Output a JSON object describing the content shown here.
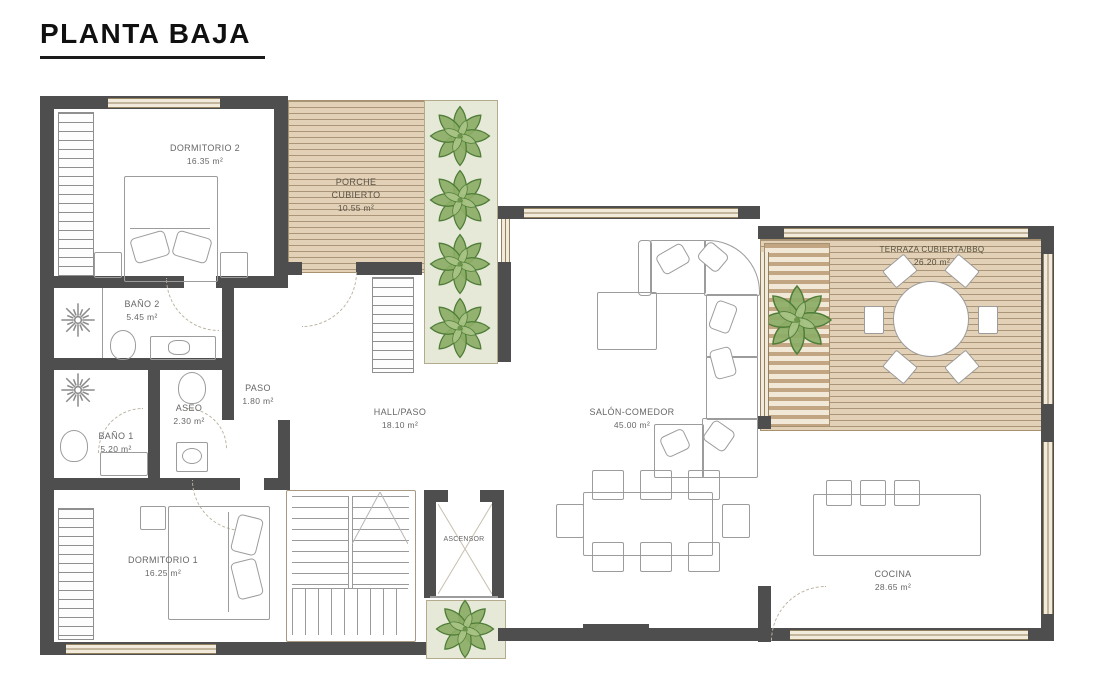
{
  "title": "PLANTA BAJA",
  "rooms": {
    "dormitorio2": {
      "name": "DORMITORIO 2",
      "area": "16.35 m²"
    },
    "porche": {
      "line1": "PORCHE",
      "line2": "CUBIERTO",
      "area": "10.55 m²"
    },
    "bano2": {
      "name": "BAÑO 2",
      "area": "5.45 m²"
    },
    "paso": {
      "name": "PASO",
      "area": "1.80 m²"
    },
    "aseo": {
      "name": "ASEO",
      "area": "2.30 m²"
    },
    "bano1": {
      "name": "BAÑO 1",
      "area": "5.20 m²"
    },
    "dormitorio1": {
      "name": "DORMITORIO 1",
      "area": "16.25 m²"
    },
    "hall": {
      "name": "HALL/PASO",
      "area": "18.10 m²"
    },
    "ascensor": {
      "name": "ASCENSOR"
    },
    "salon": {
      "name": "SALÓN-COMEDOR",
      "area": "45.00 m²"
    },
    "terraza": {
      "name": "TERRAZA CUBIERTA/BBQ",
      "area": "26.20 m²"
    },
    "cocina": {
      "name": "COCINA",
      "area": "28.65 m²"
    }
  },
  "colors": {
    "wall": "#4e4e4e",
    "deck": "#e2d1b6",
    "deck_stripe": "#7d6446",
    "planter": "#e6e9d8",
    "plant_green": "#8cad66",
    "furniture_outline": "#9c9c9c",
    "window_fill": "#f2ebdb",
    "label_text": "#676767"
  }
}
